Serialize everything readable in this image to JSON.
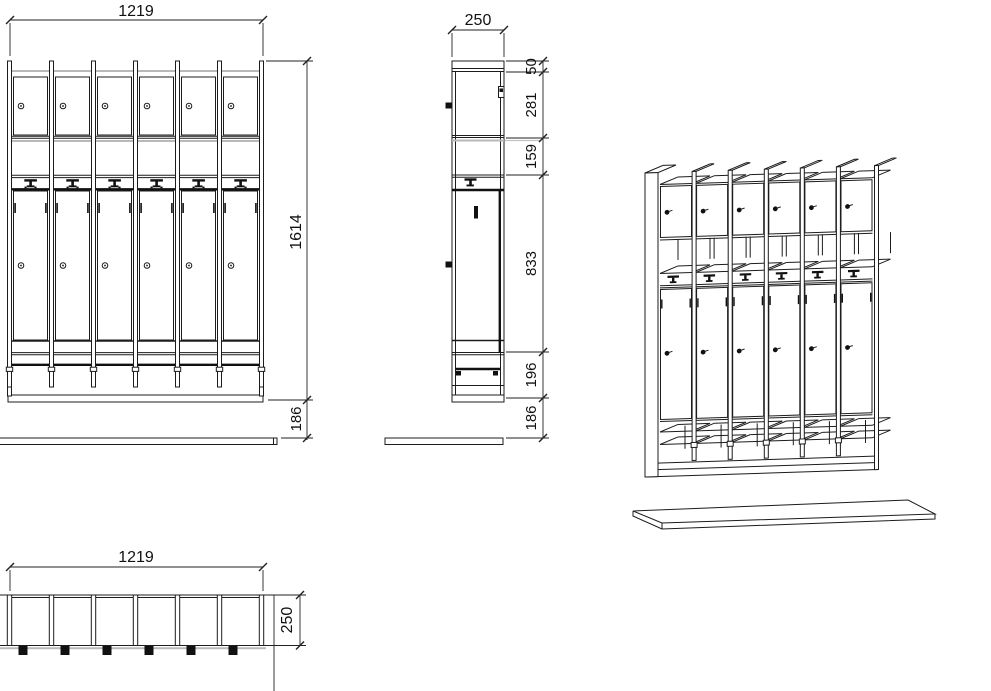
{
  "drawing_title": "locker-cabinet-technical-drawing",
  "front_view": {
    "dim_width": "1219",
    "dim_height": "1614",
    "dim_bench_gap": "186"
  },
  "side_view": {
    "dim_depth": "250",
    "dim_sections": [
      "50",
      "281",
      "159",
      "833",
      "196",
      "186"
    ]
  },
  "top_view": {
    "dim_width": "1219",
    "dim_depth": "250"
  },
  "colors": {
    "line": "#1c1c1c",
    "accent_gray": "#b9b9b9",
    "background": "#ffffff"
  }
}
